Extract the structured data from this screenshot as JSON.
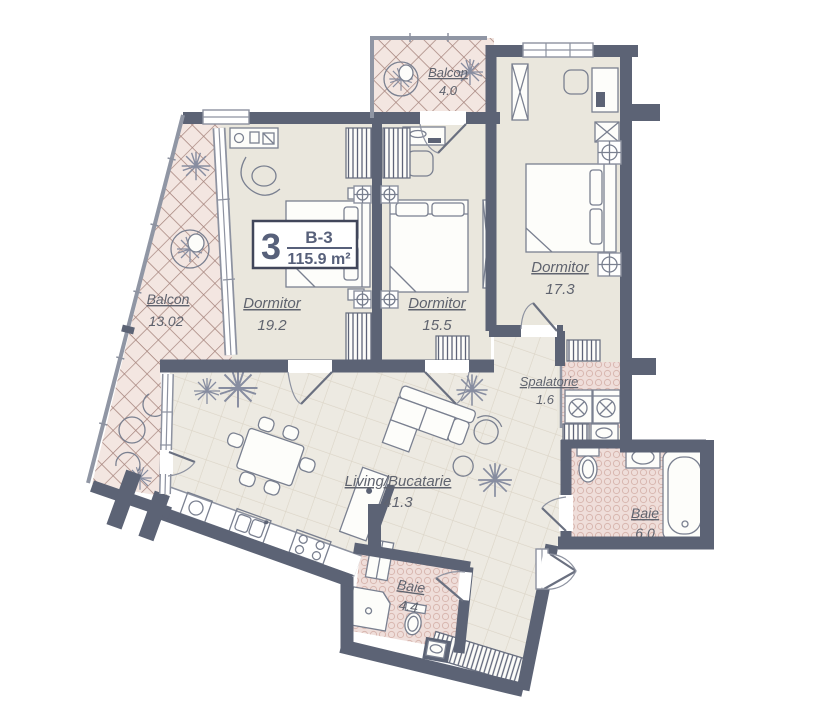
{
  "title": "Apartment floor plan",
  "unit": {
    "number": "3",
    "code": "B-3",
    "area": "115.9 m²"
  },
  "rooms": [
    {
      "id": "dormitor-19",
      "name": "Dormitor",
      "area": "19.2"
    },
    {
      "id": "dormitor-15",
      "name": "Dormitor",
      "area": "15.5"
    },
    {
      "id": "dormitor-17",
      "name": "Dormitor",
      "area": "17.3"
    },
    {
      "id": "balcon-13",
      "name": "Balcon",
      "area": "13.02"
    },
    {
      "id": "balcon-4",
      "name": "Balcon",
      "area": "4.0"
    },
    {
      "id": "living",
      "name": "Living/Bucatarie",
      "area": "41.3"
    },
    {
      "id": "spalatorie",
      "name": "Spalatorie",
      "area": "1.6"
    },
    {
      "id": "baie-6",
      "name": "Baie",
      "area": "6.0"
    },
    {
      "id": "baie-4",
      "name": "Baie",
      "area": "4.4"
    }
  ],
  "colors": {
    "wall": "#5c6375",
    "room_fill": "#eae7dd",
    "tile_fill": "#edeae2",
    "tile_line": "#dbd4c6",
    "balcony_fill": "#f3e6e1",
    "balcony_lattice": "#a5837c",
    "bath_fill": "#efdeda",
    "bath_dot": "#d8b7b0",
    "outline": "#8d92a0",
    "text": "#5f636e"
  }
}
